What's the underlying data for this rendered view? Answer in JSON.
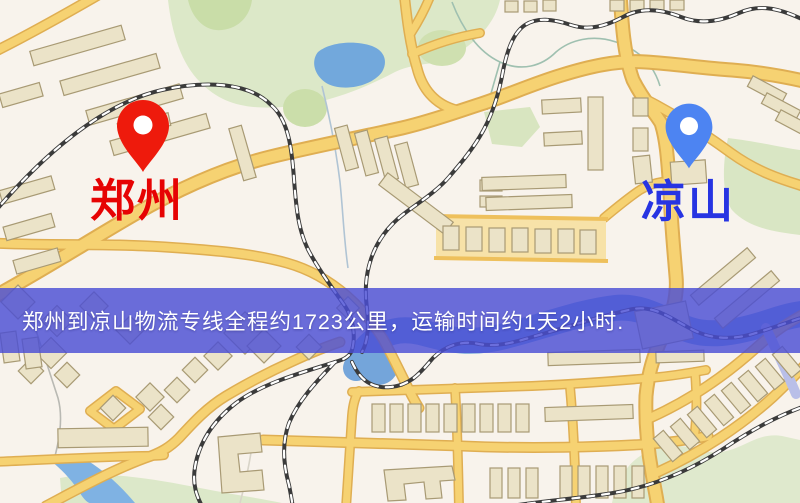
{
  "map": {
    "banner": {
      "text": "郑州到凉山物流专线全程约1723公里，运输时间约1天2小时.",
      "bg_color": "rgba(75,78,212,0.82)",
      "text_color": "#ffffff"
    },
    "markers": {
      "origin": {
        "name": "郑州",
        "pin_color": "#ee1a0c",
        "label_color": "#e60303"
      },
      "destination": {
        "name": "凉山",
        "pin_color": "#4d84f2",
        "label_color": "#2734e2"
      }
    },
    "route": {
      "from": "郑州",
      "to": "凉山",
      "distance": "约1723公里",
      "duration": "约1天2小时"
    },
    "palette": {
      "background": "#f8f3ec",
      "road": "#f6d272",
      "road_casing": "#dfae52",
      "building": "#ebe3c8",
      "park": "#dce8c8",
      "water": "#74a8dc",
      "rail": "#3b3b3b"
    }
  }
}
